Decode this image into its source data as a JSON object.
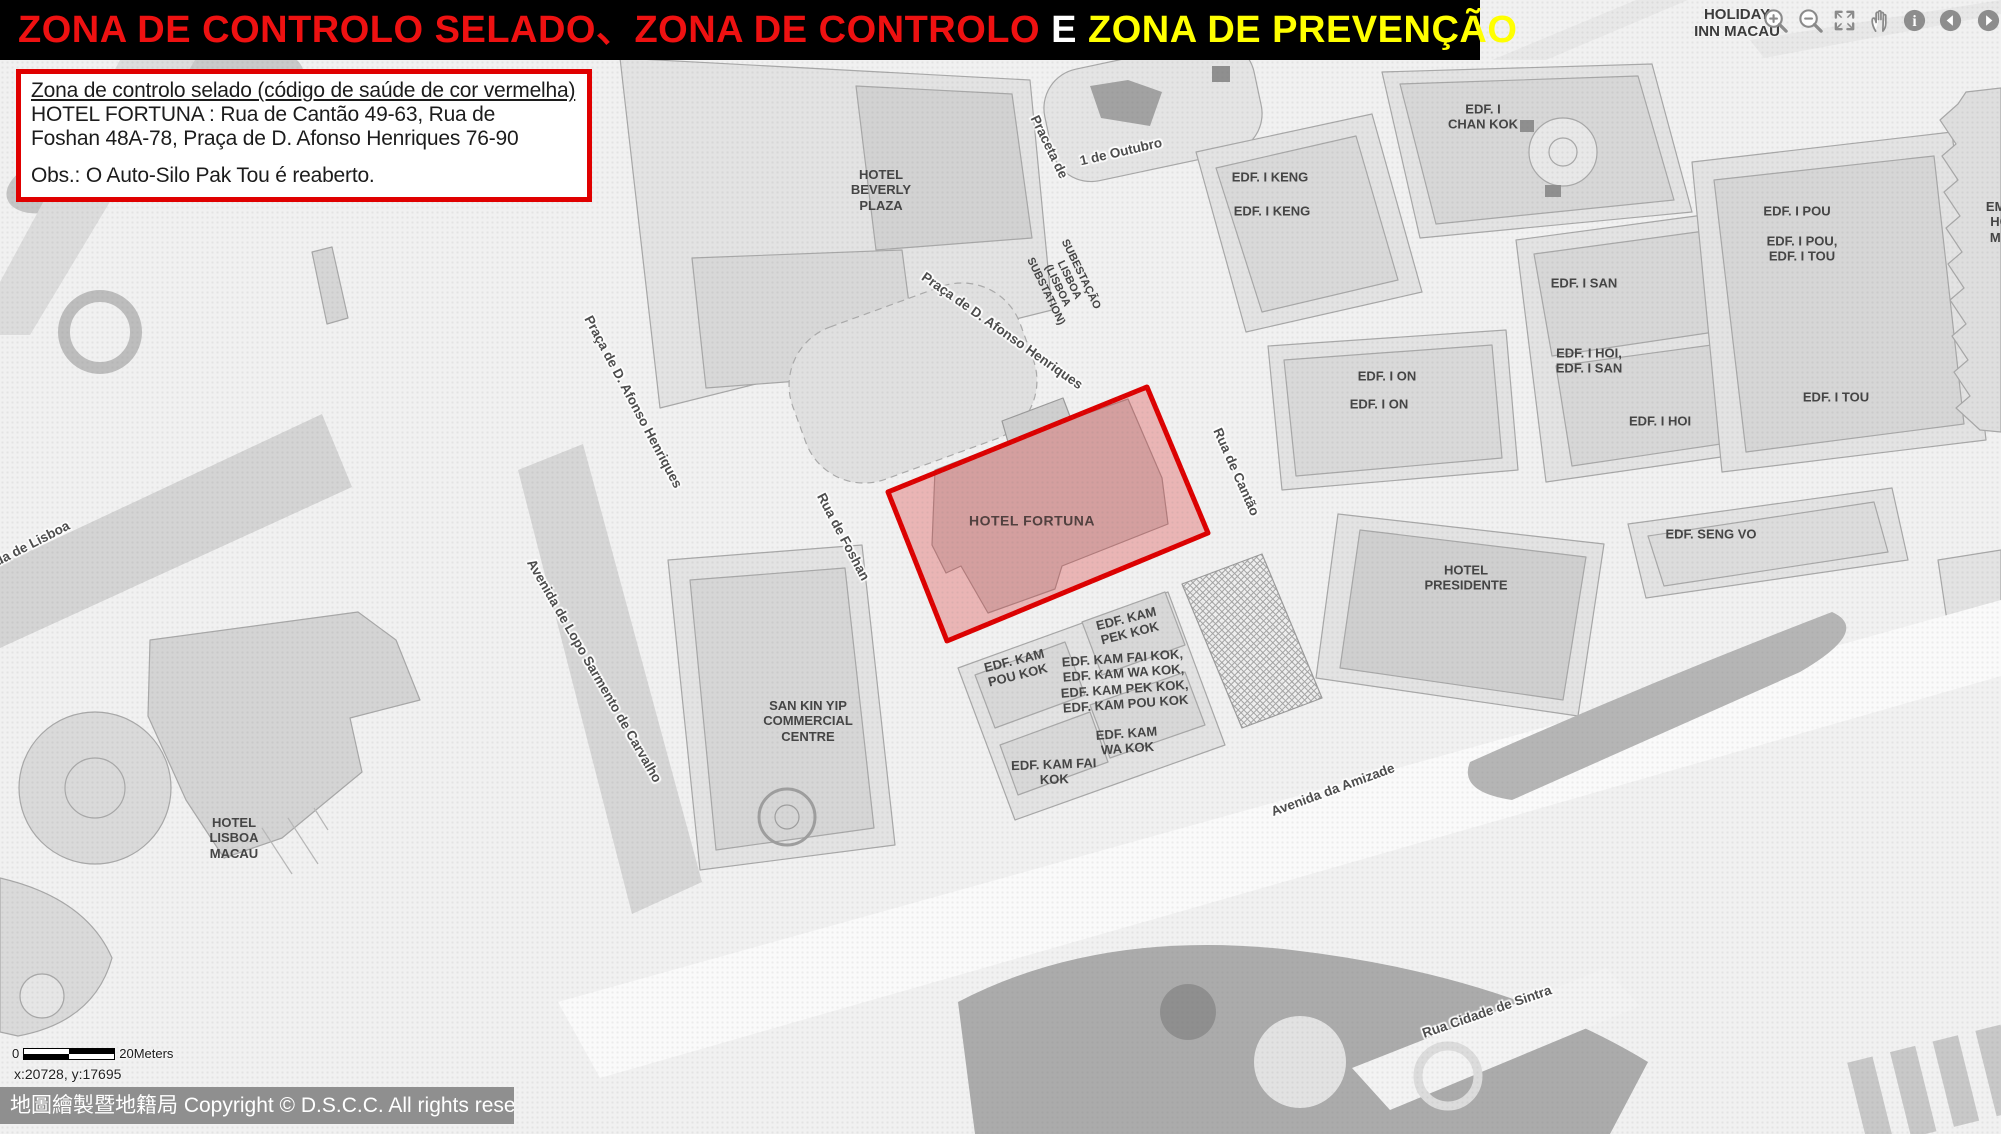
{
  "title_bar": {
    "text_red": "ZONA DE CONTROLO SELADO、ZONA DE CONTROLO ",
    "text_white": "E",
    "text_yellow": " ZONA DE PREVENÇÃO",
    "bg": "#000000",
    "red": "#ee1111",
    "white": "#ffffff",
    "yellow": "#ffff00"
  },
  "info_box": {
    "heading": "Zona de controlo selado (código de saúde de cor vermelha)",
    "address_line1": "HOTEL FORTUNA :  Rua de Cantão 49-63, Rua de",
    "address_line2": "Foshan 48A-78, Praça de D. Afonso Henriques 76-90",
    "note": "Obs.: O Auto-Silo Pak Tou é reaberto.",
    "border_color": "#e00000"
  },
  "toolbar": {
    "location_line1": "HOLIDAY",
    "location_line2": "INN MACAU",
    "icons": [
      "zoom-in",
      "zoom-out",
      "fullscreen",
      "pan-hand",
      "info",
      "back",
      "forward"
    ]
  },
  "map": {
    "control_zone": {
      "name": "Zona de controlo selado — HOTEL FORTUNA",
      "points": "1147,387 1208,533 947,641 888,492",
      "stroke": "#dd0000",
      "fill": "rgba(221,70,70,0.35)"
    },
    "labels": [
      {
        "lines": [
          "HOTEL",
          "BEVERLY",
          "PLAZA"
        ],
        "x": 881,
        "y": 190,
        "rot": 0,
        "cls": "bld"
      },
      {
        "lines": [
          "Praceta de"
        ],
        "x": 1049,
        "y": 147,
        "rot": 64,
        "cls": "street"
      },
      {
        "lines": [
          "1 de Outubro"
        ],
        "x": 1121,
        "y": 152,
        "rot": -13,
        "cls": "street"
      },
      {
        "lines": [
          "SUBESTAÇÃO",
          "LISBOA",
          "(LISBOA",
          "SUBSTATION)"
        ],
        "x": 1063,
        "y": 283,
        "rot": 64,
        "cls": "bld",
        "size": 11
      },
      {
        "lines": [
          "Praça de D. Afonso Henriques"
        ],
        "x": 1002,
        "y": 331,
        "rot": 35,
        "cls": "street"
      },
      {
        "lines": [
          "Praça de D. Afonso Henriques"
        ],
        "x": 633,
        "y": 402,
        "rot": 62,
        "cls": "street"
      },
      {
        "lines": [
          "Rua de Foshan"
        ],
        "x": 843,
        "y": 537,
        "rot": 62,
        "cls": "street"
      },
      {
        "lines": [
          "Rua de Cantão"
        ],
        "x": 1236,
        "y": 472,
        "rot": 66,
        "cls": "street"
      },
      {
        "lines": [
          "Avenida de Lopo Sarmento de Carvalho"
        ],
        "x": 594,
        "y": 671,
        "rot": 60,
        "cls": "street"
      },
      {
        "lines": [
          "Avenida de Lisboa"
        ],
        "x": 16,
        "y": 552,
        "rot": -27,
        "cls": "street"
      },
      {
        "lines": [
          "Avenida da Amizade"
        ],
        "x": 1333,
        "y": 790,
        "rot": -20,
        "cls": "street"
      },
      {
        "lines": [
          "Rua Cidade de Sintra"
        ],
        "x": 1487,
        "y": 1012,
        "rot": -19,
        "cls": "street"
      },
      {
        "lines": [
          "da do"
        ],
        "x": 637,
        "y": 46,
        "rot": -28,
        "cls": "street"
      },
      {
        "lines": [
          "EDF. I",
          "CHAN KOK"
        ],
        "x": 1483,
        "y": 117,
        "rot": 0,
        "cls": "bld"
      },
      {
        "lines": [
          "EDF. I KENG"
        ],
        "x": 1270,
        "y": 177,
        "rot": 0,
        "cls": "bld"
      },
      {
        "lines": [
          "EDF. I KENG"
        ],
        "x": 1272,
        "y": 211,
        "rot": 0,
        "cls": "bld"
      },
      {
        "lines": [
          "EDF. I ON"
        ],
        "x": 1387,
        "y": 376,
        "rot": 0,
        "cls": "bld"
      },
      {
        "lines": [
          "EDF. I ON"
        ],
        "x": 1379,
        "y": 404,
        "rot": 0,
        "cls": "bld"
      },
      {
        "lines": [
          "EDF. I SAN"
        ],
        "x": 1584,
        "y": 283,
        "rot": 0,
        "cls": "bld"
      },
      {
        "lines": [
          "EDF. I HOI,",
          "EDF. I SAN"
        ],
        "x": 1589,
        "y": 361,
        "rot": 0,
        "cls": "bld"
      },
      {
        "lines": [
          "EDF. I HOI"
        ],
        "x": 1660,
        "y": 421,
        "rot": 0,
        "cls": "bld"
      },
      {
        "lines": [
          "EDF. I POU"
        ],
        "x": 1797,
        "y": 211,
        "rot": 0,
        "cls": "bld"
      },
      {
        "lines": [
          "EDF. I POU,",
          "EDF. I TOU"
        ],
        "x": 1802,
        "y": 249,
        "rot": 0,
        "cls": "bld"
      },
      {
        "lines": [
          "EDF. I TOU"
        ],
        "x": 1836,
        "y": 397,
        "rot": 0,
        "cls": "bld"
      },
      {
        "lines": [
          "EMP",
          "HO",
          "MA"
        ],
        "x": 2000,
        "y": 222,
        "rot": 0,
        "cls": "bld"
      },
      {
        "lines": [
          "EDF. SENG VO"
        ],
        "x": 1711,
        "y": 534,
        "rot": 0,
        "cls": "bld"
      },
      {
        "lines": [
          "HOTEL",
          "PRESIDENTE"
        ],
        "x": 1466,
        "y": 578,
        "rot": 0,
        "cls": "bld"
      },
      {
        "lines": [
          "HOTEL FORTUNA"
        ],
        "x": 1032,
        "y": 521,
        "rot": 0,
        "cls": "zone"
      },
      {
        "lines": [
          "EDF. KAM",
          "PEK KOK"
        ],
        "x": 1128,
        "y": 626,
        "rot": -14,
        "cls": "bld"
      },
      {
        "lines": [
          "EDF. KAM",
          "POU KOK"
        ],
        "x": 1016,
        "y": 668,
        "rot": -14,
        "cls": "bld"
      },
      {
        "lines": [
          "EDF. KAM FAI KOK,",
          "EDF. KAM WA KOK,",
          "EDF. KAM PEK KOK,",
          "EDF. KAM POU KOK"
        ],
        "x": 1124,
        "y": 681,
        "rot": -4,
        "cls": "bld"
      },
      {
        "lines": [
          "EDF. KAM",
          "WA KOK"
        ],
        "x": 1127,
        "y": 741,
        "rot": -4,
        "cls": "bld"
      },
      {
        "lines": [
          "EDF. KAM FAI",
          "KOK"
        ],
        "x": 1054,
        "y": 772,
        "rot": -2,
        "cls": "bld"
      },
      {
        "lines": [
          "SAN KIN YIP",
          "COMMERCIAL",
          "CENTRE"
        ],
        "x": 808,
        "y": 721,
        "rot": 0,
        "cls": "bld"
      },
      {
        "lines": [
          "HOTEL",
          "LISBOA",
          "MACAU"
        ],
        "x": 234,
        "y": 838,
        "rot": 0,
        "cls": "bld"
      }
    ]
  },
  "scale_bar": {
    "zero": "0",
    "label": "20Meters"
  },
  "status": {
    "coordinates": "x:20728, y:17695"
  },
  "copyright": "地圖繪製暨地籍局 Copyright © D.S.C.C. All rights reserved"
}
